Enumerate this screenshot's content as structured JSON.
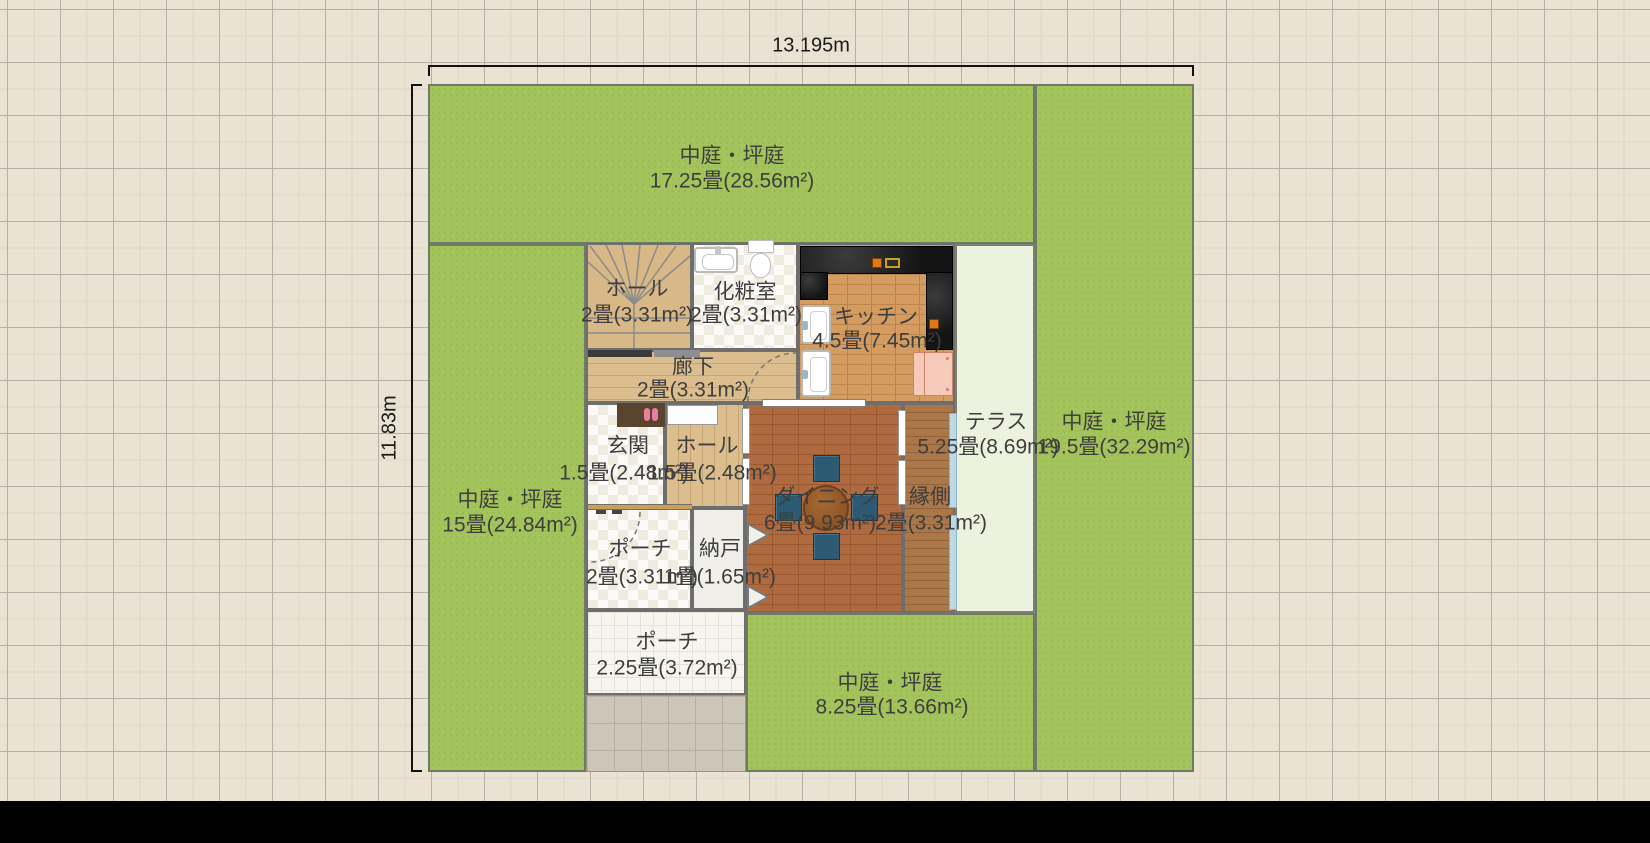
{
  "app": "floor-plan-editor-canvas",
  "dimensions": {
    "width_label": "13.195m",
    "height_label": "11.83m"
  },
  "gardens": [
    {
      "id": "top",
      "name": "中庭・坪庭",
      "area": "17.25畳(28.56m²)"
    },
    {
      "id": "right",
      "name": "中庭・坪庭",
      "area": "19.5畳(32.29m²)"
    },
    {
      "id": "left",
      "name": "中庭・坪庭",
      "area": "15畳(24.84m²)"
    },
    {
      "id": "bottom",
      "name": "中庭・坪庭",
      "area": "8.25畳(13.66m²)"
    }
  ],
  "rooms": [
    {
      "id": "stair-hall",
      "name": "ホール",
      "area": "2畳(3.31m²)"
    },
    {
      "id": "powder-room",
      "name": "化粧室",
      "area": "2畳(3.31m²)"
    },
    {
      "id": "kitchen",
      "name": "キッチン",
      "area": "4.5畳(7.45m²)"
    },
    {
      "id": "corridor",
      "name": "廊下",
      "area": "2畳(3.31m²)"
    },
    {
      "id": "entrance",
      "name": "玄関",
      "area": "1.5畳(2.48m²)"
    },
    {
      "id": "hall",
      "name": "ホール",
      "area": "1.5畳(2.48m²)"
    },
    {
      "id": "porch-2",
      "name": "ポーチ",
      "area": "2畳(3.31m²)"
    },
    {
      "id": "storage",
      "name": "納戸",
      "area": "1畳(1.65m²)"
    },
    {
      "id": "dining",
      "name": "ダイニング",
      "area": "6畳(9.93m²)"
    },
    {
      "id": "engawa",
      "name": "縁側",
      "area": "2畳(3.31m²)"
    },
    {
      "id": "terrace",
      "name": "テラス",
      "area": "5.25畳(8.69m²)"
    },
    {
      "id": "porch-225",
      "name": "ポーチ",
      "area": "2.25畳(3.72m²)"
    }
  ],
  "palette": {
    "background": "#eae2d2",
    "grid_strong": "#b8b0a2",
    "grid_fine": "#ded6c6",
    "garden_green": "#a3c45c",
    "terrace": "#edf2de",
    "dining_floor": "#b06a3f",
    "kitchen_floor": "#d49c60",
    "engawa_floor": "#aa7748",
    "wood_floor": "#dcbd8e",
    "wall": "#6e6e6e",
    "counter_black": "#1e1e1e",
    "fridge_pink": "#f6cab9",
    "chair_blue": "#2c5a72",
    "table_brown": "#8d5426",
    "label_text": "#3e3e3e",
    "bottom_bar": "#000000"
  }
}
